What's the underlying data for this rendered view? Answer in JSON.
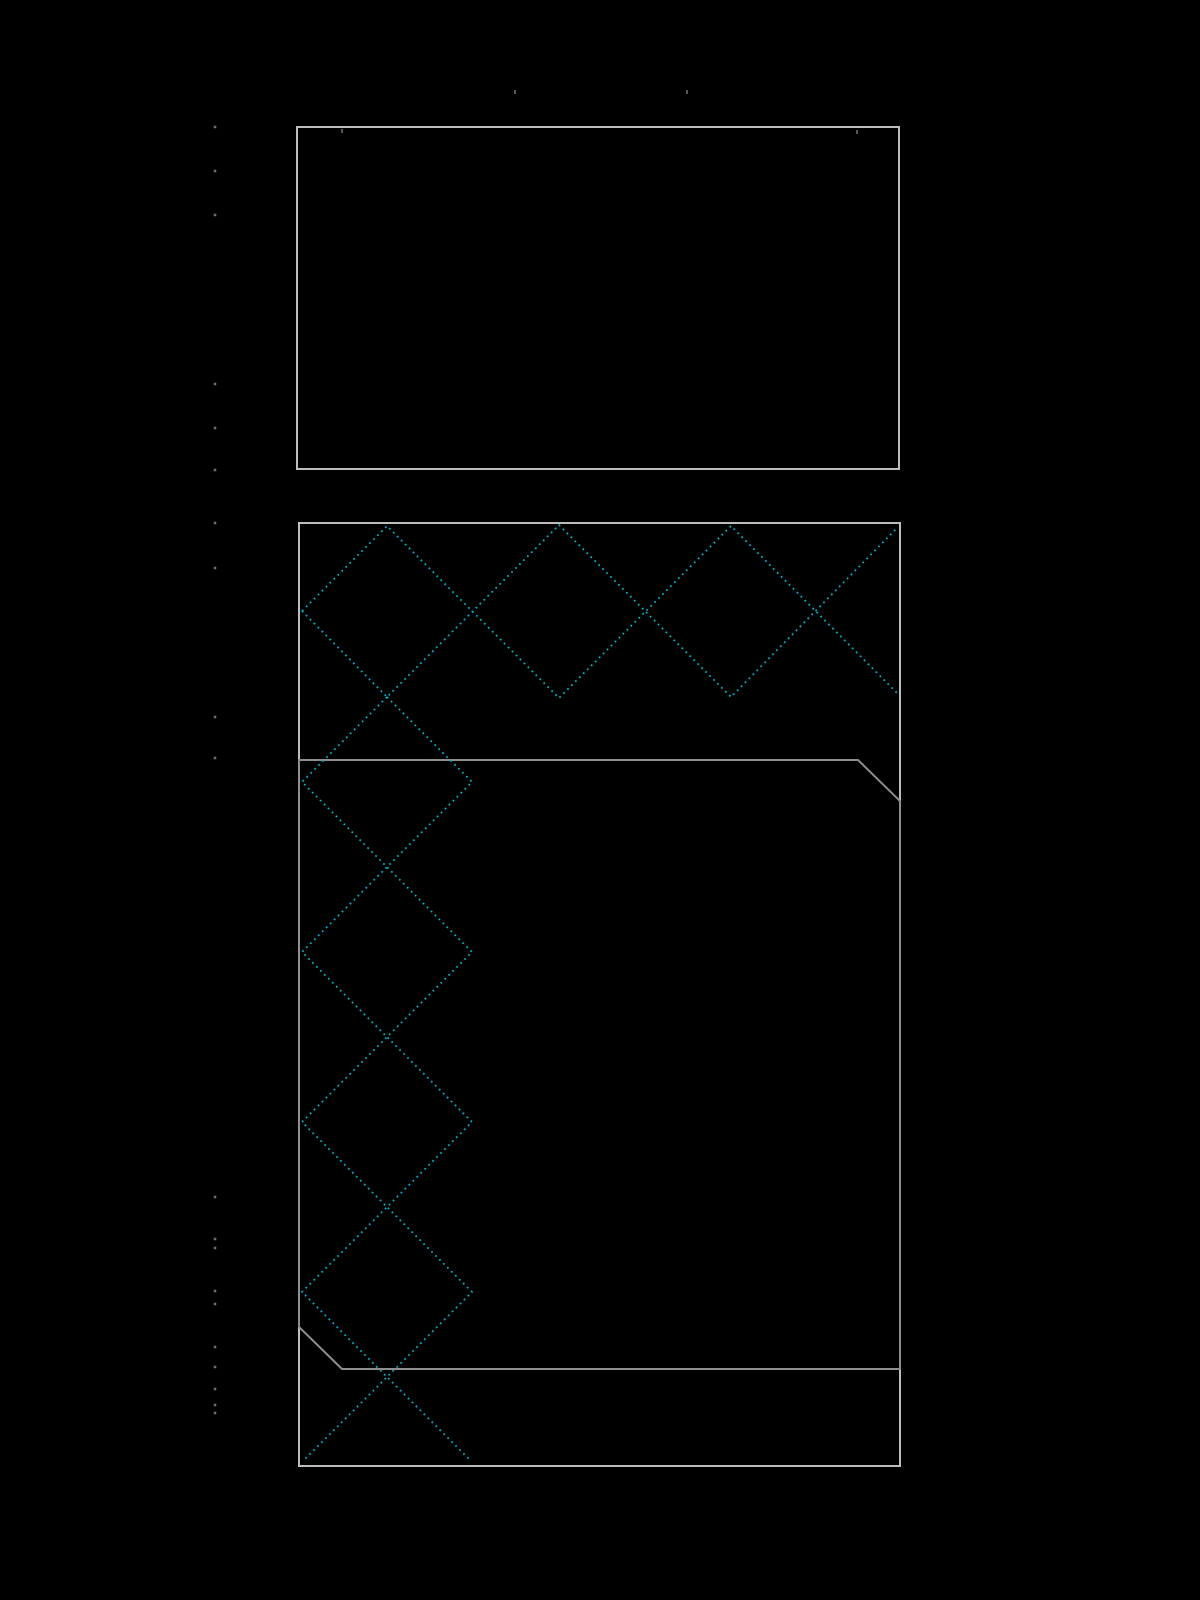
{
  "canvas": {
    "width": 1200,
    "height": 1600,
    "background": "#000000"
  },
  "colors": {
    "outer_outline": "#bdbdbd",
    "inner_outline": "#8e8e8e",
    "hatch": "#00aec0",
    "tick_dot": "#707070",
    "faint_mark": "#555555"
  },
  "rectangles": [
    {
      "name": "top-rectangle-outline",
      "x": 297,
      "y": 127,
      "width": 602,
      "height": 342
    },
    {
      "name": "bottom-rectangle-outline",
      "x": 299,
      "y": 523,
      "width": 601,
      "height": 943
    }
  ],
  "inner_polygon": {
    "name": "chamfered-panel-outline",
    "points": [
      [
        299,
        760
      ],
      [
        858,
        760
      ],
      [
        900,
        801
      ],
      [
        900,
        1369
      ],
      [
        342,
        1369
      ],
      [
        299,
        1327
      ]
    ]
  },
  "hatch_polylines": [
    {
      "name": "top-hatch-zigzag-a",
      "points": [
        [
          302,
          611
        ],
        [
          387,
          526
        ],
        [
          559,
          698
        ],
        [
          731,
          526
        ],
        [
          899,
          695
        ]
      ]
    },
    {
      "name": "top-hatch-zigzag-b",
      "points": [
        [
          302,
          611
        ],
        [
          387,
          697
        ],
        [
          559,
          525
        ],
        [
          731,
          697
        ],
        [
          897,
          528
        ]
      ]
    },
    {
      "name": "left-hatch-zigzag-a",
      "points": [
        [
          387,
          697
        ],
        [
          472,
          782
        ],
        [
          302,
          952
        ],
        [
          472,
          1122
        ],
        [
          302,
          1292
        ],
        [
          469,
          1459
        ]
      ]
    },
    {
      "name": "left-hatch-zigzag-b",
      "points": [
        [
          387,
          697
        ],
        [
          302,
          782
        ],
        [
          472,
          952
        ],
        [
          302,
          1122
        ],
        [
          472,
          1292
        ],
        [
          303,
          1461
        ]
      ]
    }
  ],
  "tick_dots": {
    "x": 215,
    "size": 2.5,
    "ys": [
      127,
      171,
      215,
      384,
      428,
      470,
      523,
      568,
      717,
      758,
      1197,
      1239,
      1248,
      1291,
      1304,
      1347,
      1367,
      1389,
      1405,
      1413
    ]
  },
  "faint_marks": [
    [
      515,
      92
    ],
    [
      687,
      92
    ],
    [
      342,
      131
    ],
    [
      857,
      132
    ]
  ],
  "stroke": {
    "outline_width": 2,
    "hatch_width": 1.8,
    "hatch_dasharray": "1.8 3.8"
  }
}
